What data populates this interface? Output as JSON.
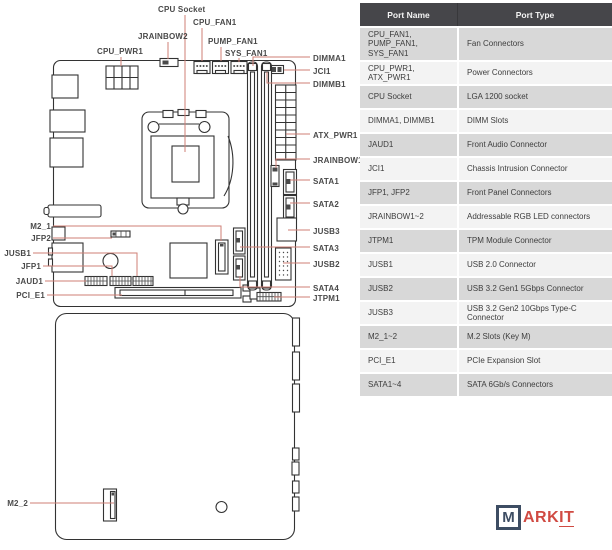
{
  "diagram": {
    "labels": {
      "cpu_socket": "CPU Socket",
      "cpu_fan1": "CPU_FAN1",
      "jrainbow2": "JRAINBOW2",
      "pump_fan1": "PUMP_FAN1",
      "cpu_pwr1": "CPU_PWR1",
      "sys_fan1": "SYS_FAN1",
      "dimma1": "DIMMA1",
      "jci1": "JCI1",
      "dimmb1": "DIMMB1",
      "atx_pwr1": "ATX_PWR1",
      "jrainbow1": "JRAINBOW1",
      "sata1": "SATA1",
      "sata2": "SATA2",
      "jusb3": "JUSB3",
      "sata3": "SATA3",
      "jusb2": "JUSB2",
      "sata4": "SATA4",
      "jtpm1": "JTPM1",
      "m2_1": "M2_1",
      "jfp2": "JFP2",
      "jusb1": "JUSB1",
      "jfp1": "JFP1",
      "jaud1": "JAUD1",
      "pci_e1": "PCI_E1",
      "m2_2": "M2_2"
    }
  },
  "table": {
    "headers": [
      "Port Name",
      "Port Type"
    ],
    "rows": [
      {
        "name": "CPU_FAN1, PUMP_FAN1, SYS_FAN1",
        "type": "Fan Connectors"
      },
      {
        "name": "CPU_PWR1, ATX_PWR1",
        "type": "Power Connectors"
      },
      {
        "name": "CPU Socket",
        "type": "LGA 1200 socket"
      },
      {
        "name": "DIMMA1, DIMMB1",
        "type": "DIMM Slots"
      },
      {
        "name": "JAUD1",
        "type": "Front Audio Connector"
      },
      {
        "name": "JCI1",
        "type": "Chassis Intrusion Connector"
      },
      {
        "name": "JFP1, JFP2",
        "type": "Front Panel Connectors"
      },
      {
        "name": "JRAINBOW1~2",
        "type": "Addressable RGB LED connectors"
      },
      {
        "name": "JTPM1",
        "type": "TPM Module Connector"
      },
      {
        "name": "JUSB1",
        "type": "USB 2.0 Connector"
      },
      {
        "name": "JUSB2",
        "type": "USB 3.2 Gen1 5Gbps Connector"
      },
      {
        "name": "JUSB3",
        "type": "USB 3.2 Gen2 10Gbps Type-C Connector"
      },
      {
        "name": "M2_1~2",
        "type": "M.2 Slots (Key M)"
      },
      {
        "name": "PCI_E1",
        "type": "PCIe Expansion Slot"
      },
      {
        "name": "SATA1~4",
        "type": "SATA 6Gb/s Connectors"
      }
    ]
  },
  "logo": {
    "boxed_letter": "M",
    "text_plain": "ARK",
    "text_underlined": "IT"
  },
  "colors": {
    "leader_line": "#cf7f76",
    "accent_red": "#d04a42",
    "logo_navy": "#3d4d63",
    "header_bg": "#46464a",
    "row_gray": "#d8d8d8",
    "outline": "#333333"
  }
}
